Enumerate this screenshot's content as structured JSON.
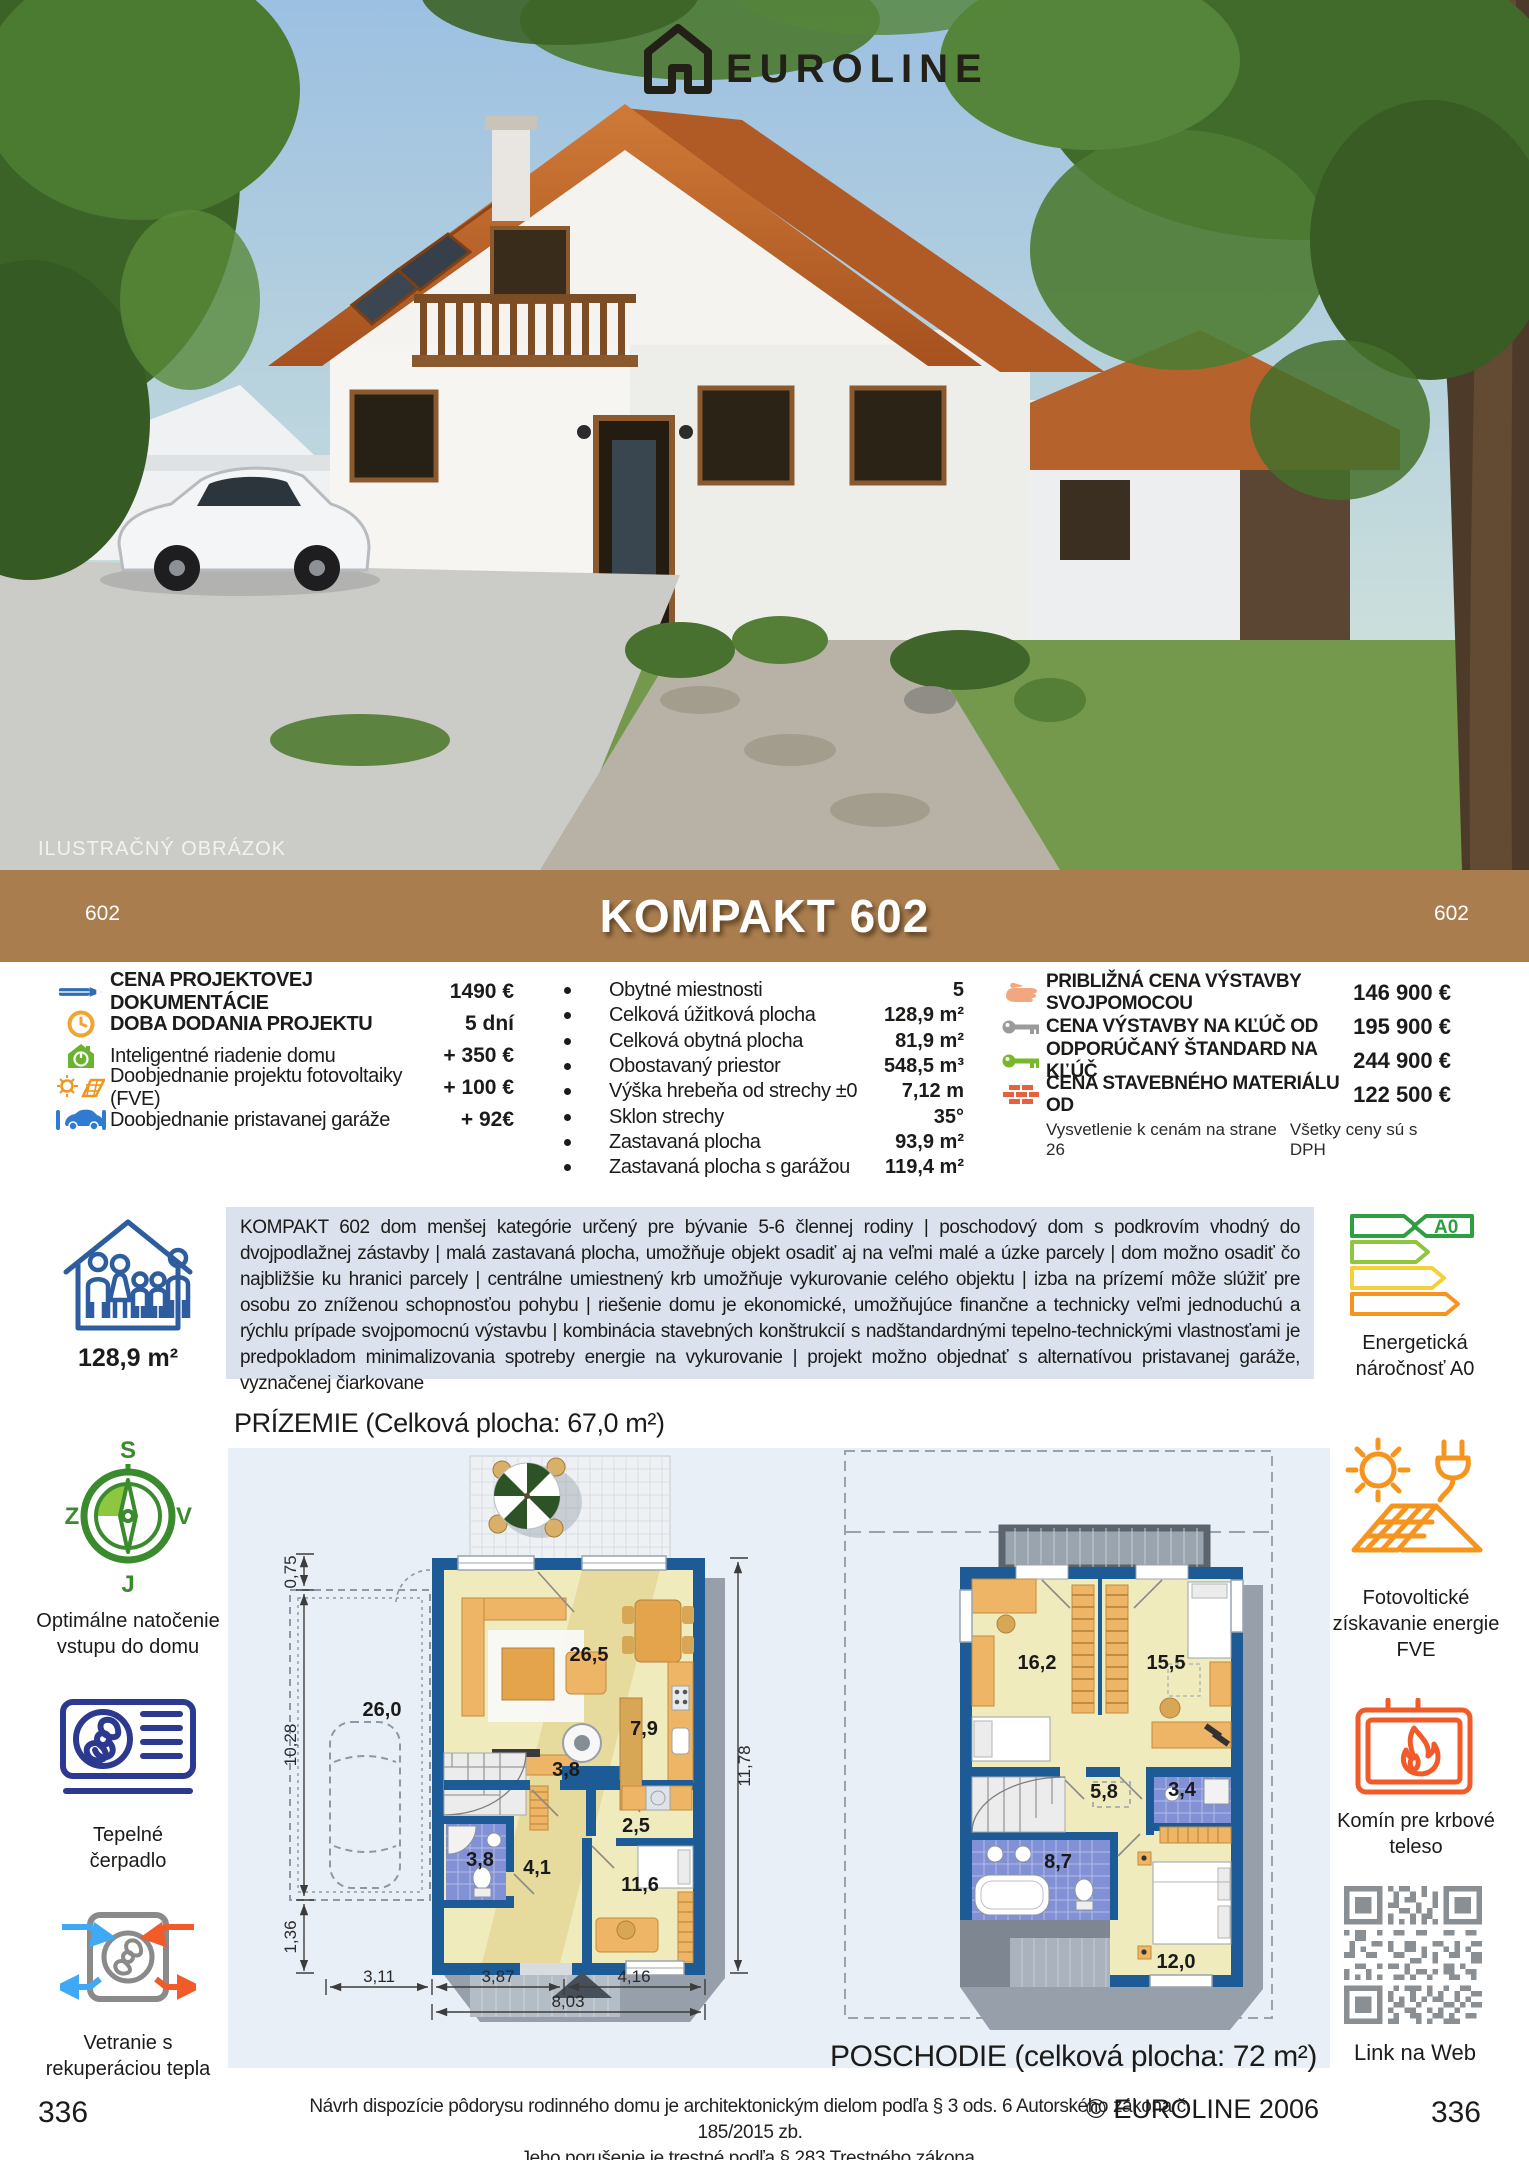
{
  "logo": {
    "name": "EUROLINE"
  },
  "photo": {
    "caption": "ILUSTRAČNÝ OBRÁZOK"
  },
  "title_bar": {
    "left_code": "602",
    "title": "KOMPAKT 602",
    "right_code": "602"
  },
  "pricing_left": {
    "rows": [
      {
        "icon": "pencil-icon",
        "label": "CENA PROJEKTOVEJ DOKUMENTÁCIE",
        "value": "1490 €"
      },
      {
        "icon": "clock-icon",
        "label": "DOBA DODANIA PROJEKTU",
        "value": "5 dní"
      },
      {
        "icon": "smart-home-icon",
        "label": "Inteligentné riadenie domu",
        "value": "+ 350 €"
      },
      {
        "icon": "solar-project-icon",
        "label": "Doobjednanie projektu fotovoltaiky (FVE)",
        "value": "+ 100 €"
      },
      {
        "icon": "garage-icon",
        "label": "Doobjednanie pristavanej garáže",
        "value": "+ 92€"
      }
    ]
  },
  "specs": {
    "rows": [
      {
        "label": "Obytné miestnosti",
        "value": "5"
      },
      {
        "label": "Celková úžitková plocha",
        "value": "128,9 m²"
      },
      {
        "label": "Celková obytná plocha",
        "value": "81,9 m²"
      },
      {
        "label": "Obostavaný priestor",
        "value": "548,5 m³"
      },
      {
        "label": "Výška hrebeňa od strechy ±0",
        "value": "7,12 m"
      },
      {
        "label": "Sklon strechy",
        "value": "35°"
      },
      {
        "label": "Zastavaná plocha",
        "value": "93,9 m²"
      },
      {
        "label": "Zastavaná plocha s garážou",
        "value": "119,4 m²"
      }
    ]
  },
  "pricing_right": {
    "rows": [
      {
        "icon": "hand-icon",
        "label": "PRIBLIŽNÁ CENA VÝSTAVBY SVOJPOMOCOU",
        "value": "146 900 €"
      },
      {
        "icon": "key-gray-icon",
        "label": "CENA VÝSTAVBY NA KĽÚČ OD",
        "value": "195 900 €"
      },
      {
        "icon": "key-green-icon",
        "label": "ODPORÚČANÝ ŠTANDARD NA KĽÚČ",
        "value": "244 900 €"
      },
      {
        "icon": "bricks-icon",
        "label": "CENA STAVEBNÉHO MATERIÁLU OD",
        "value": "122 500 €"
      }
    ],
    "note_left": "Vysvetlenie k cenám na strane 26",
    "note_right": "Všetky ceny sú s DPH"
  },
  "overview": {
    "area": "128,9 m²",
    "description": "KOMPAKT 602 dom menšej kategórie určený pre bývanie 5-6 člennej rodiny | poschodový dom s podkrovím vhodný do dvojpodlažnej zástavby | malá zastavaná plocha, umožňuje objekt osadiť aj na veľmi malé a úzke parcely | dom možno osadiť čo najbližšie ku hranici parcely | centrálne umiestnený krb umožňuje vykurovanie celého objektu | izba na prízemí môže slúžiť pre osobu zo zníženou schopnosťou pohybu | riešenie domu je ekonomické, umožňujúce finančne a technicky veľmi jednoduchú a rýchlu prípade svojpomocnú výstavbu | kombinácia stavebných konštrukcií s nadštandardnými tepelno-technickými vlastnosťami je predpokladom minimalizovania spotreby energie na vykurovanie | projekt možno objednať s alternatívou pristavanej garáže, vyznačenej čiarkovane",
    "energy_badge": "A0",
    "energy_label_1": "Energetická",
    "energy_label_2": "náročnosť A0"
  },
  "sidebar_left": {
    "compass": {
      "n": "S",
      "e": "V",
      "s": "J",
      "w": "Z",
      "line1": "Optimálne natočenie",
      "line2": "vstupu do domu"
    },
    "heatpump": {
      "line1": "Tepelné",
      "line2": "čerpadlo"
    },
    "ventilation": {
      "line1": "Vetranie s",
      "line2": "rekuperáciou tepla"
    }
  },
  "sidebar_right": {
    "pv": {
      "line1": "Fotovoltické",
      "line2": "získavanie energie",
      "line3": "FVE"
    },
    "fireplace": {
      "line1": "Komín pre krbové",
      "line2": "teleso"
    },
    "qr": {
      "label": "Link na Web"
    }
  },
  "plans": {
    "ground": {
      "heading": "PRÍZEMIE (Celková plocha: 67,0 m²)",
      "rooms": [
        "26,5",
        "7,9",
        "3,8",
        "2,5",
        "3,8",
        "4,1",
        "11,6",
        "26,0"
      ],
      "dims": [
        "0,75",
        "10,28",
        "1,36",
        "3,11",
        "3,87",
        "4,16",
        "8,03",
        "11,78"
      ]
    },
    "upper": {
      "heading": "POSCHODIE (celková plocha: 72 m²)",
      "rooms": [
        "16,2",
        "15,5",
        "5,8",
        "3,4",
        "8,7",
        "12,0"
      ]
    }
  },
  "footer": {
    "page_left": "336",
    "page_right": "336",
    "legal_line1": "Návrh dispozície pôdorysu rodinného domu je architektonickým dielom podľa § 3 ods. 6 Autorského zákona č. 185/2015 zb.",
    "legal_line2": "Jeho porušenie je trestné podľa § 283 Trestného zákona.",
    "copyright": "© EUROLINE 2006"
  }
}
